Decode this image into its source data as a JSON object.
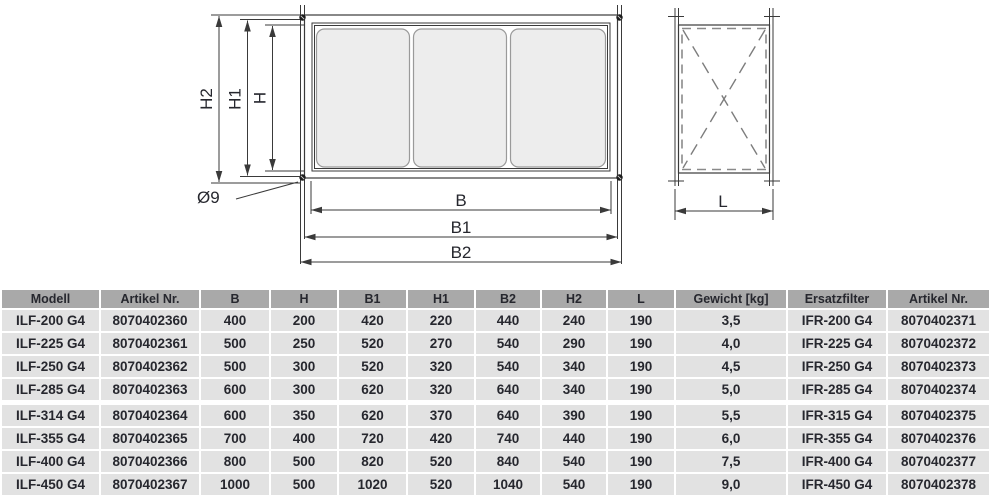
{
  "diagram": {
    "front_view": {
      "dim_h2": "H2",
      "dim_h1": "H1",
      "dim_h": "H",
      "dim_b": "B",
      "dim_b1": "B1",
      "dim_b2": "B2",
      "hole_diameter": "Ø9"
    },
    "side_view": {
      "dim_l": "L"
    },
    "colors": {
      "line": "#3a3a3a",
      "dashed": "#8a8a8a",
      "panel_fill": "#ededed"
    }
  },
  "table": {
    "header_bg": "#a9a9a9",
    "row_bg": "#e2e2e2",
    "text_color": "#26272e",
    "headers": [
      "Modell",
      "Artikel Nr.",
      "B",
      "H",
      "B1",
      "H1",
      "B2",
      "H2",
      "L",
      "Gewicht [kg]",
      "Ersatzfilter",
      "Artikel Nr."
    ],
    "rows": [
      [
        "ILF-200 G4",
        "8070402360",
        "400",
        "200",
        "420",
        "220",
        "440",
        "240",
        "190",
        "3,5",
        "IFR-200 G4",
        "8070402371"
      ],
      [
        "ILF-225 G4",
        "8070402361",
        "500",
        "250",
        "520",
        "270",
        "540",
        "290",
        "190",
        "4,0",
        "IFR-225 G4",
        "8070402372"
      ],
      [
        "ILF-250 G4",
        "8070402362",
        "500",
        "300",
        "520",
        "320",
        "540",
        "340",
        "190",
        "4,5",
        "IFR-250 G4",
        "8070402373"
      ],
      [
        "ILF-285 G4",
        "8070402363",
        "600",
        "300",
        "620",
        "320",
        "640",
        "340",
        "190",
        "5,0",
        "IFR-285 G4",
        "8070402374"
      ],
      [
        "ILF-314 G4",
        "8070402364",
        "600",
        "350",
        "620",
        "370",
        "640",
        "390",
        "190",
        "5,5",
        "IFR-315 G4",
        "8070402375"
      ],
      [
        "ILF-355 G4",
        "8070402365",
        "700",
        "400",
        "720",
        "420",
        "740",
        "440",
        "190",
        "6,0",
        "IFR-355 G4",
        "8070402376"
      ],
      [
        "ILF-400 G4",
        "8070402366",
        "800",
        "500",
        "820",
        "520",
        "840",
        "540",
        "190",
        "7,5",
        "IFR-400 G4",
        "8070402377"
      ],
      [
        "ILF-450 G4",
        "8070402367",
        "1000",
        "500",
        "1020",
        "520",
        "1040",
        "540",
        "190",
        "9,0",
        "IFR-450 G4",
        "8070402378"
      ]
    ]
  }
}
